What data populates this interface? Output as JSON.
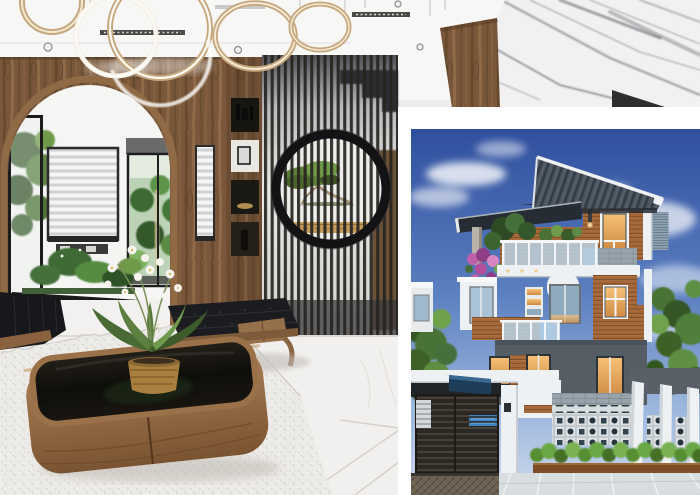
{
  "page": {
    "background": "#ffffff"
  },
  "collage": {
    "interior_photo": {
      "name": "interior-living-room-render"
    },
    "house_photo": {
      "name": "modern-house-exterior-render",
      "border_color": "#ffffff"
    }
  },
  "colors": {
    "page_bg": "#ffffff",
    "white_frame": "#ffffff",
    "ceiling": "#f7f7f6",
    "wood_dark": "#5e4227",
    "wood_mid": "#7a573a",
    "wood_light": "#97744f",
    "frame_black": "#1c1c1c",
    "room_wall": "#f5f5f4",
    "marble_base": "#f1f1f2",
    "marble_vein": "#8e8e94",
    "floor": "#f1f0ee",
    "rug": "#edebe7",
    "slat_dark": "#262420",
    "mirror_ring": "#131316",
    "gold": "#c39a58",
    "sofa_black": "#17181b",
    "bench_black": "#1b1c1f",
    "table_wood": "#96704a",
    "glass_black": "#14120f",
    "orchid_white": "#f6f4ef",
    "ring_gold": "#c7a87e",
    "sky_top": "#2f4f9e",
    "sky_low": "#9ab4dc",
    "roof_grey": "#4b5560",
    "canopy_dark": "#262c33",
    "siding": "#a5683a",
    "trim_white": "#eef1f3",
    "stone_band": "#97a1a9",
    "glass_blue": "#b9d2e6",
    "warm_light": "#f0b36d",
    "ground_grey": "#565e65",
    "gate_dark": "#2b2723",
    "pool_blue": "#3e86c8",
    "breeze_bg": "#dde1e3",
    "breeze_hole": "#25333d",
    "hedge_green": "#578f33",
    "planter_wood": "#7c4e27",
    "drive_tile": "#d8dde0",
    "drive_paver": "#6b6052",
    "tree_green": "#4a7334",
    "tree_dark": "#355426",
    "tree_light": "#6fa24c",
    "flower_pink": "#c060ab"
  }
}
